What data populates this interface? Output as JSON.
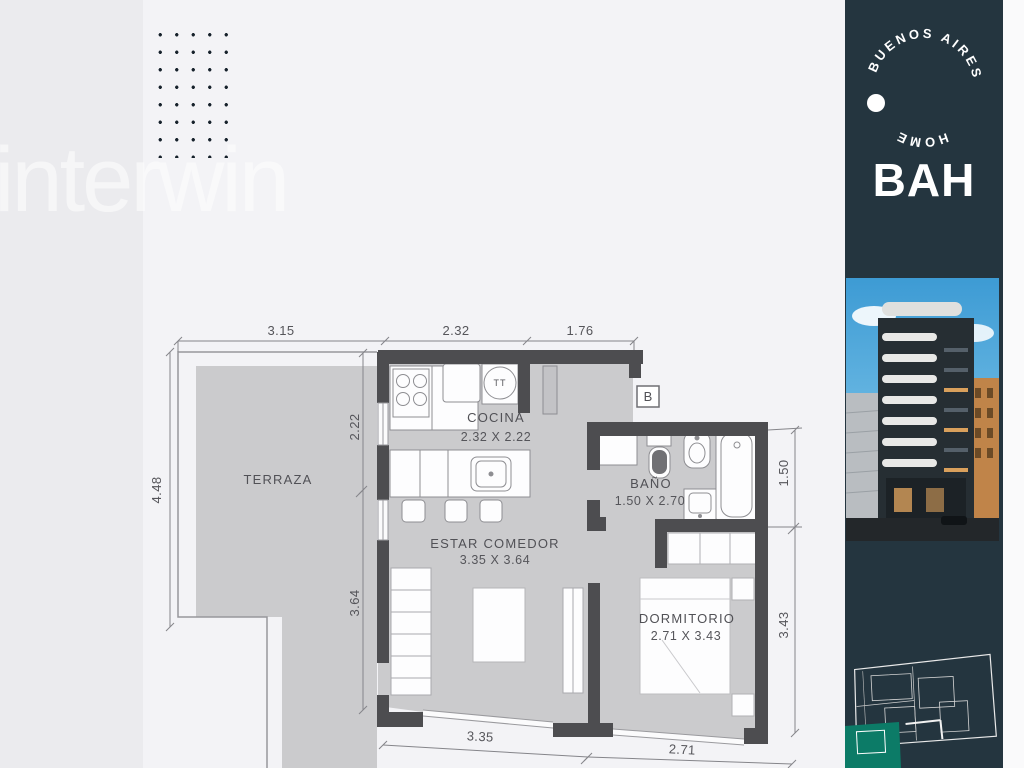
{
  "watermark_text": "interwin",
  "sidebar": {
    "arc_text_top": "BUENOS AIRES",
    "arc_text_bottom": "HOME",
    "logo": "BAH"
  },
  "plan": {
    "unit_badge": "B",
    "appliance_tt": "TT",
    "rooms": {
      "terraza": {
        "label": "TERRAZA"
      },
      "cocina": {
        "label": "COCINA",
        "size": "2.32 X 2.22"
      },
      "bano": {
        "label": "BAÑO",
        "size": "1.50 X 2.70"
      },
      "estar": {
        "label": "ESTAR COMEDOR",
        "size": "3.35 X 3.64"
      },
      "dormitorio": {
        "label": "DORMITORIO",
        "size": "2.71 X 3.43"
      }
    },
    "dims": {
      "top_1": "3.15",
      "top_2": "2.32",
      "top_3": "1.76",
      "left_1": "4.48",
      "mid_1": "2.22",
      "mid_2": "3.64",
      "right_1": "1.50",
      "right_2": "3.43",
      "bottom_1": "3.35",
      "bottom_2": "2.71"
    }
  },
  "colors": {
    "sidebar_bg": "#24353f",
    "teal_accent": "#0c7b67",
    "wall": "#4d4d50",
    "floor": "#cbcbcd",
    "sky": "#3d9bd4"
  }
}
